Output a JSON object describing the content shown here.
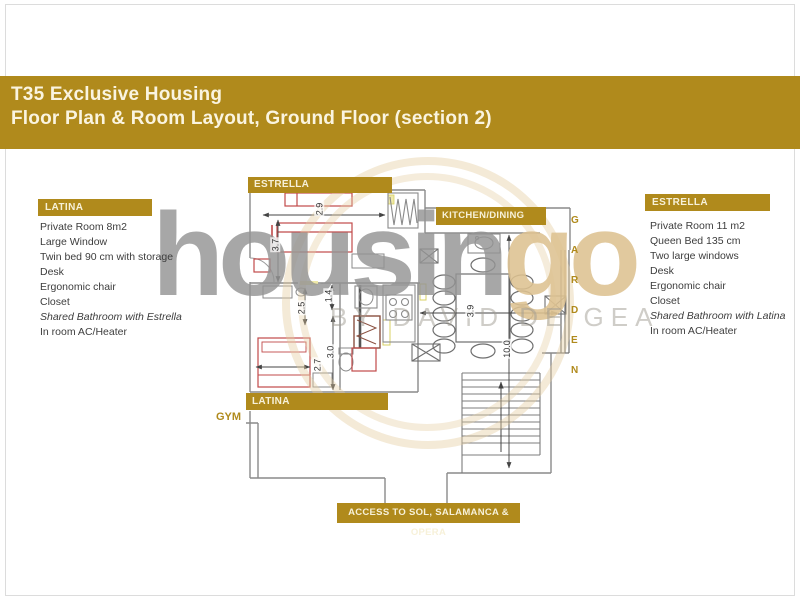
{
  "header": {
    "line1": "T35 Exclusive Housing",
    "line2": "Floor Plan & Room Layout, Ground Floor (section 2)"
  },
  "left_panel": {
    "label": "LATINA",
    "items": [
      "Private Room 8m2",
      "Large Window",
      "Twin bed 90 cm with storage",
      "Desk",
      "Ergonomic chair",
      "Closet",
      "Shared Bathroom with Estrella",
      "In room AC/Heater"
    ]
  },
  "right_panel": {
    "label": "ESTRELLA",
    "items": [
      "Private Room 11 m2",
      "Queen Bed 135 cm",
      "Two large windows",
      "Desk",
      "Ergonomic chair",
      "Closet",
      "Shared Bathroom with Latina",
      "In room AC/Heater"
    ]
  },
  "plan": {
    "labels": {
      "estrella": "ESTRELLA",
      "kitchen_dining": "KITCHEN/DINING",
      "latina": "LATINA",
      "gym": "GYM",
      "access": "ACCESS TO SOL, SALAMANCA & OPERA"
    },
    "garden_letters": [
      "G",
      "A",
      "R",
      "D",
      "E",
      "N"
    ],
    "dimensions": {
      "estrella_width": "2.9",
      "estrella_depth": "3.7",
      "bath_small": "2.5",
      "bath_tiny": "1.4",
      "hall_depth": "3.0",
      "latina_width": "2.7",
      "dining_width": "3.9",
      "total_depth": "10.0"
    }
  },
  "watermark": {
    "brand_gray": "housin",
    "brand_gold": "go",
    "tagline": "BY DAVID DE GEA"
  },
  "colors": {
    "gold": "#b08a1c",
    "band_text": "#faf4e0",
    "wall_gray": "#8a8a8a",
    "furniture_red": "#c14a4a",
    "watermark_gray": "#949494",
    "watermark_tan": "#ddc291"
  }
}
